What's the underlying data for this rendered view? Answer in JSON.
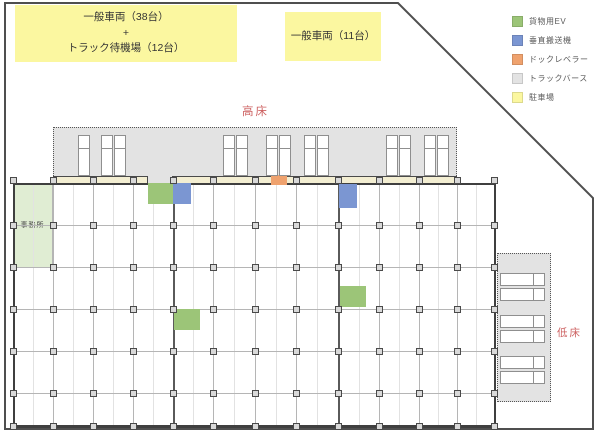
{
  "diagram": {
    "parking_zones": [
      {
        "lines": [
          "一般車両（38台）",
          "+",
          "トラック待機場（12台）"
        ]
      },
      {
        "lines": [
          "一般車両（11台）"
        ]
      }
    ],
    "labels": {
      "high_floor": "高床",
      "low_floor": "低床",
      "office": "事務所"
    },
    "legend": {
      "items": [
        {
          "name": "cargo-elevator",
          "label": "貨物用EV",
          "color": "#9cc578"
        },
        {
          "name": "vertical-conveyor",
          "label": "垂直搬送機",
          "color": "#7b96d2"
        },
        {
          "name": "dock-leveler",
          "label": "ドックレベラー",
          "color": "#efa26e"
        },
        {
          "name": "truck-berth",
          "label": "トラックバース",
          "color": "#e3e3e3"
        },
        {
          "name": "parking",
          "label": "駐車場",
          "color": "#fbf7a0"
        }
      ]
    },
    "features": [
      {
        "type": "cargo-elevator",
        "x": 148,
        "y": 183,
        "w": 25,
        "h": 21
      },
      {
        "type": "vertical-conveyor",
        "x": 173,
        "y": 183,
        "w": 18,
        "h": 21
      },
      {
        "type": "dock-leveler",
        "x": 271,
        "y": 175,
        "w": 16,
        "h": 10
      },
      {
        "type": "vertical-conveyor",
        "x": 339,
        "y": 184,
        "w": 18,
        "h": 24
      },
      {
        "type": "cargo-elevator",
        "x": 340,
        "y": 286,
        "w": 26,
        "h": 21
      },
      {
        "type": "cargo-elevator",
        "x": 174,
        "y": 309,
        "w": 26,
        "h": 21
      }
    ],
    "berths": {
      "top_slot_x": [
        78,
        101,
        114,
        223,
        236,
        266,
        279,
        304,
        317,
        386,
        399,
        424,
        437
      ],
      "right_slot_y": [
        273,
        288,
        315,
        330,
        356,
        371
      ]
    }
  }
}
